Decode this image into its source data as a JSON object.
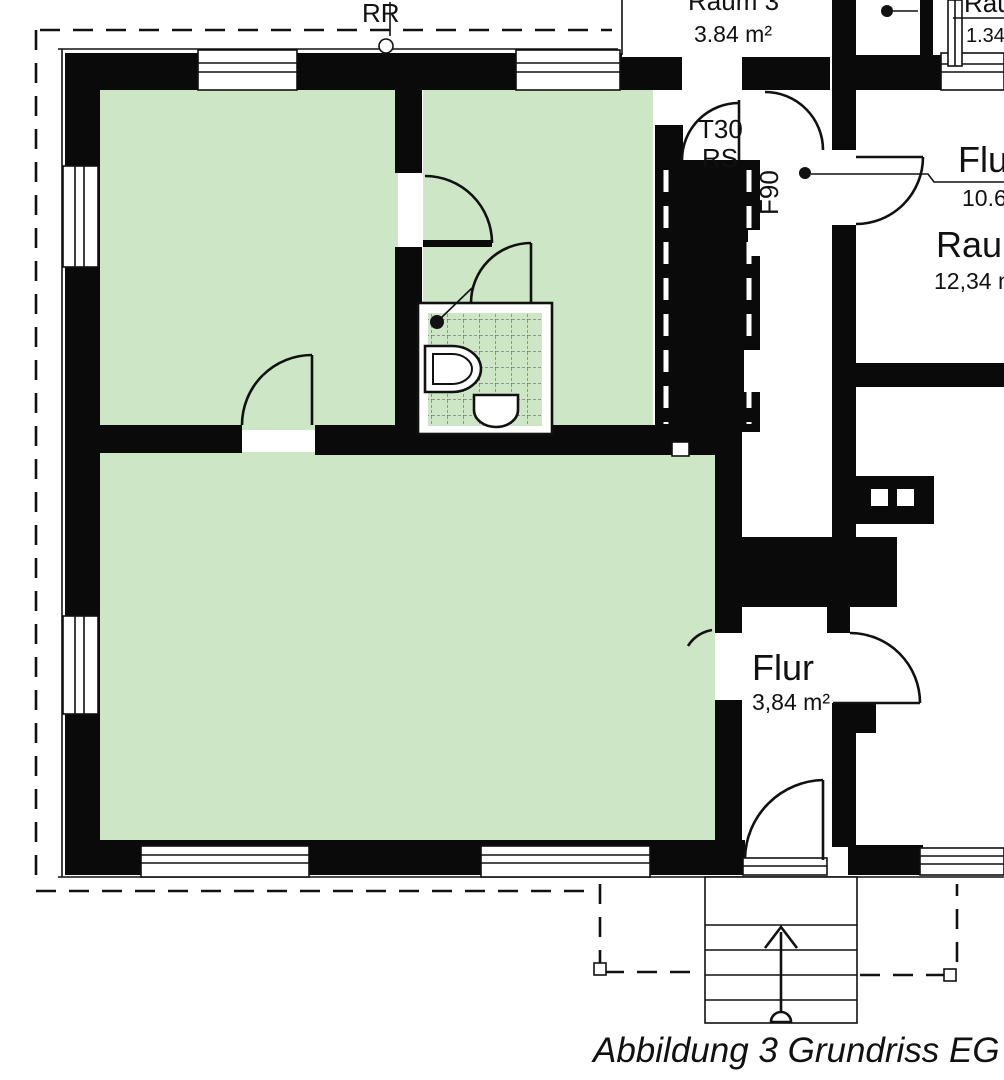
{
  "colors": {
    "room_fill": "#cde6c5",
    "wall": "#0a0a0a",
    "paper": "#ffffff"
  },
  "plan": {
    "caption": "Abbildung 3 Grundriss EG",
    "labels": {
      "rr": "RR",
      "room_top": {
        "name": "Raum 3",
        "area": "3.84 m²"
      },
      "room_top_right": {
        "name": "Raum",
        "area": "1.34"
      },
      "door_t30_line1": "T30",
      "door_t30_line2": "RS",
      "f90": "F90",
      "flur_right": {
        "name": "Flur",
        "area": "10.68"
      },
      "raum_right": {
        "name": "Raum",
        "area": "12,34 m²"
      },
      "flur_small": {
        "name": "Flur",
        "area": "3,84 m²"
      }
    }
  }
}
